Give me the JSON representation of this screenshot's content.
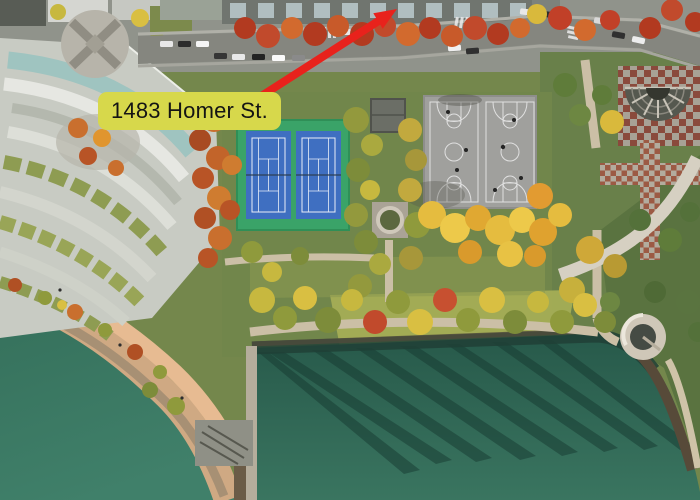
{
  "annotation": {
    "label": "1483 Homer St.",
    "label_bg_color": "#d7d84b",
    "label_text_color": "#141414",
    "arrow_color": "#e8221c"
  },
  "scene": {
    "type": "aerial-photo",
    "subject": "Aerial view of a waterfront park with two blue tennis courts, two grey basketball courts, autumn trees, a curved terraced condo complex, seawall promenade, pier and teal water with tree shadows",
    "palette": {
      "water": "#3a7560",
      "water_dark_shore": "#1f473c",
      "lawn": "#74874c",
      "lawn_sunlit": "#a4ad55",
      "tennis_pad_green": "#3aa368",
      "tennis_court_blue": "#3f6fc1",
      "basketball_pad_grey": "#a0a09d",
      "street_grey": "#85867f",
      "promenade_pink": "#e7bb92",
      "beach_sand": "#cfa983",
      "autumn_yellow": "#e5bc3f",
      "autumn_orange": "#c96f2e",
      "autumn_red": "#c14a2c",
      "tree_green": "#5f7c3a",
      "building_light": "#c8cbc3",
      "building_glass": "#9fc4c0",
      "plaza_tile_red": "#9c5a44"
    }
  }
}
